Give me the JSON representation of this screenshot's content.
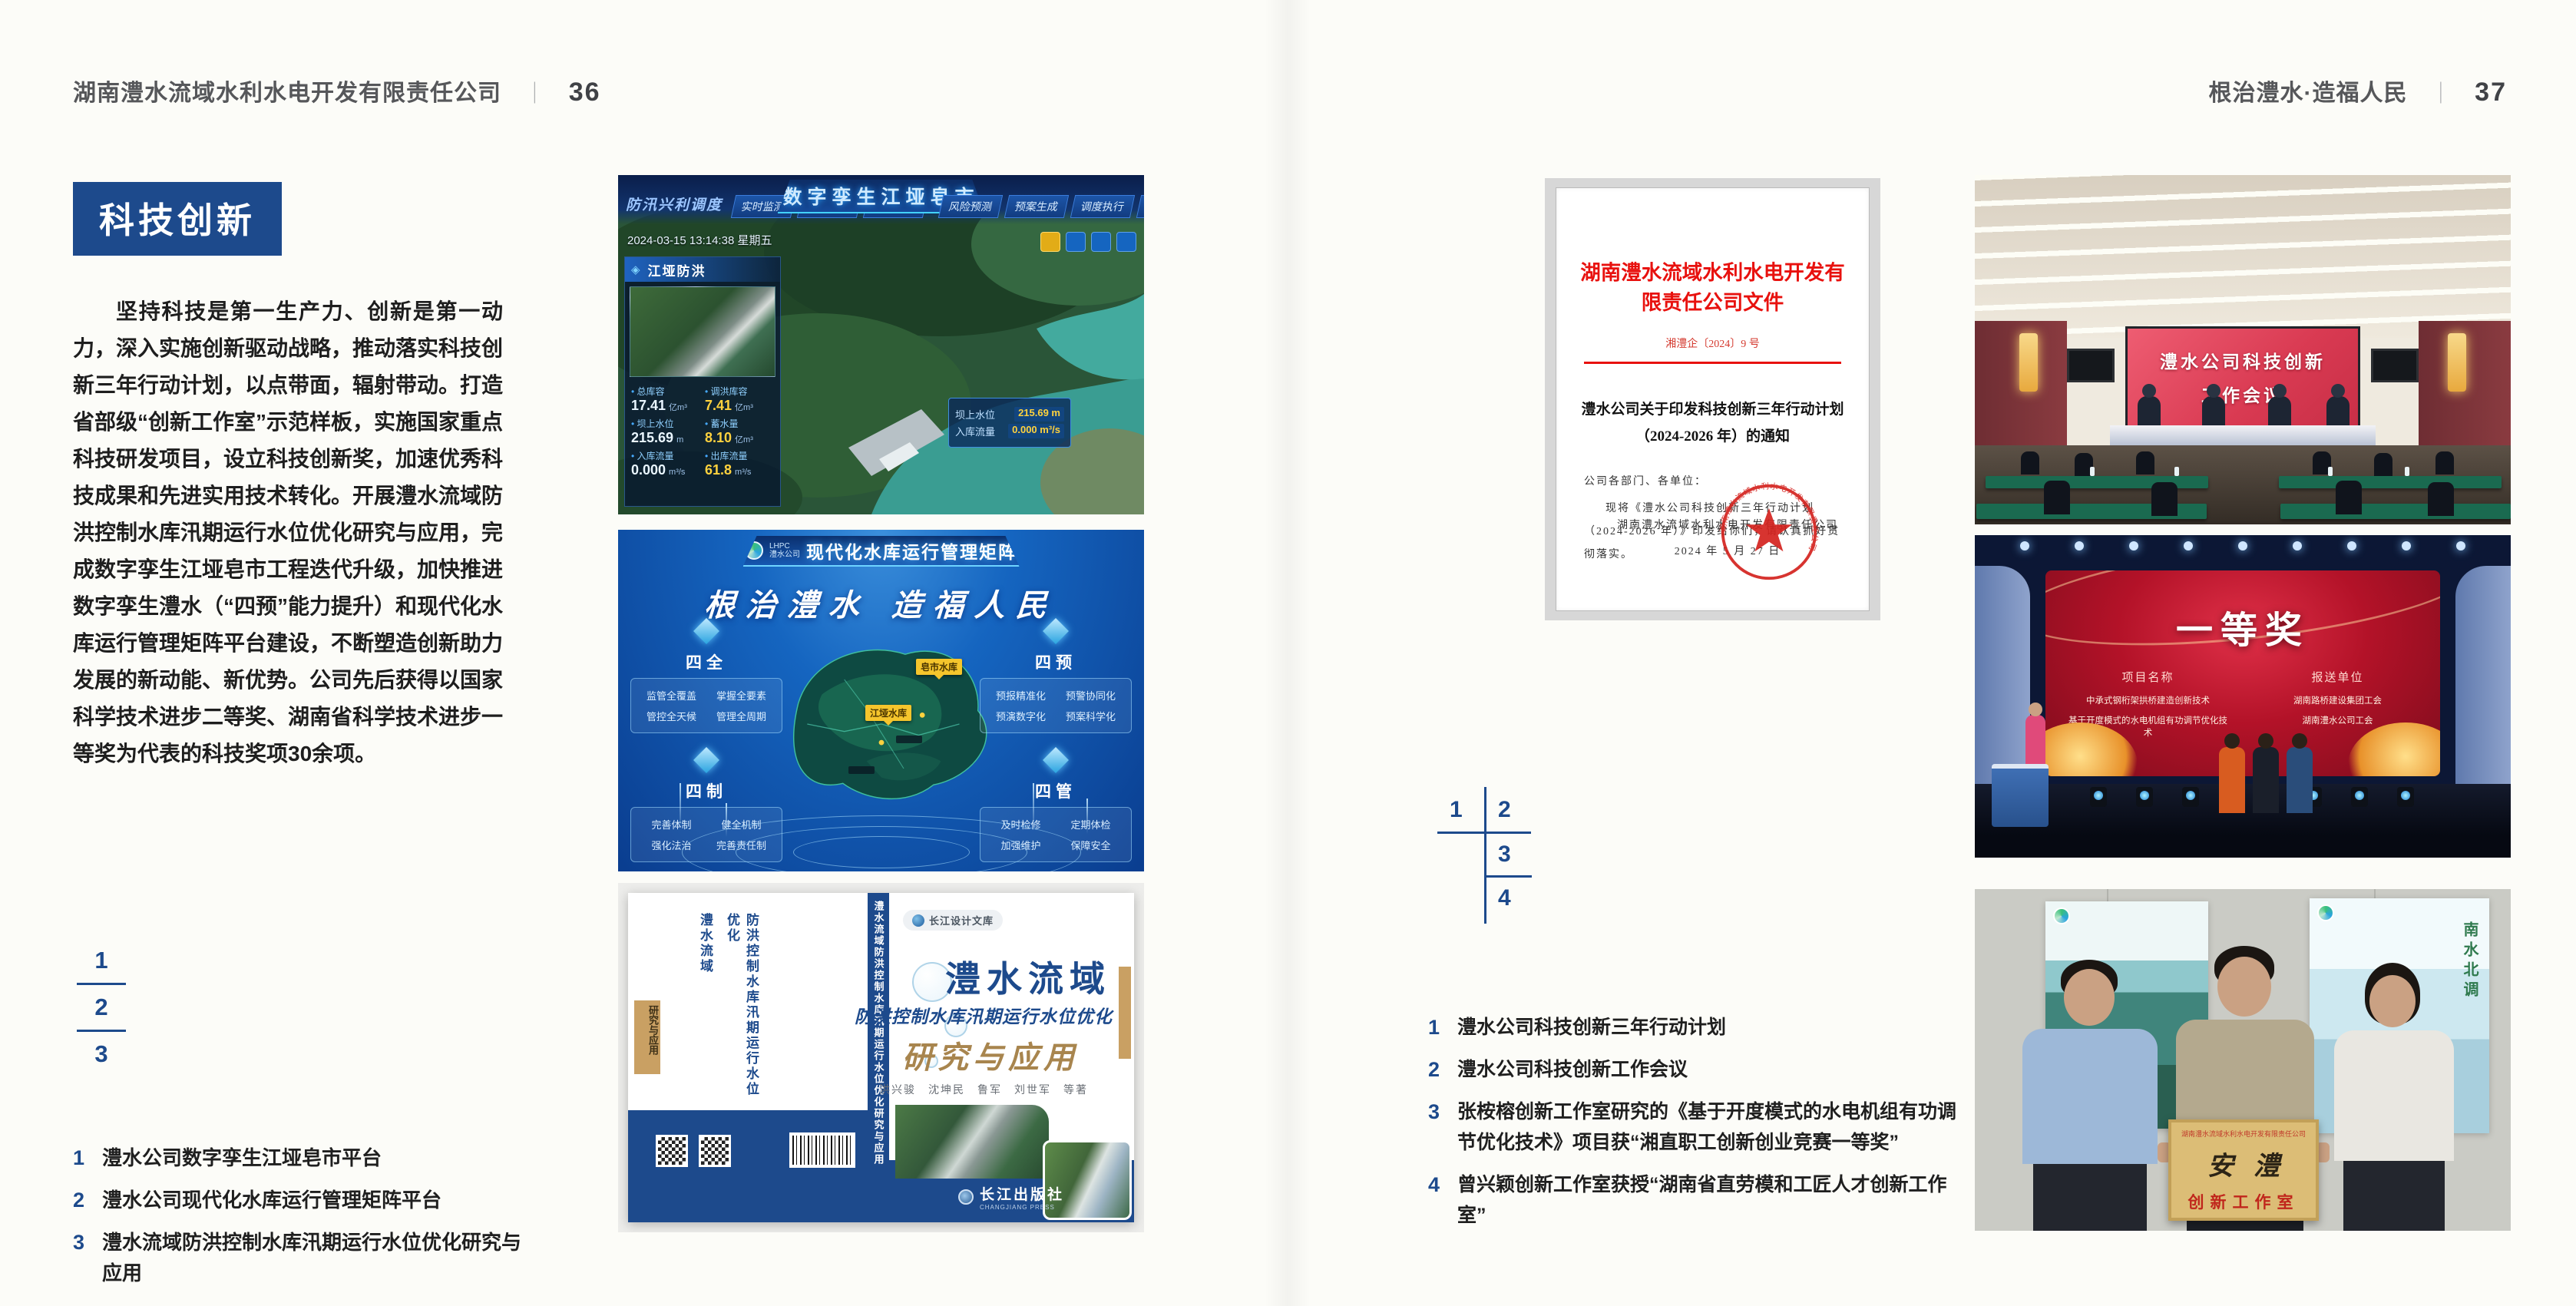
{
  "left_page": {
    "header_company": "湖南澧水流域水利水电开发有限责任公司",
    "header_sep": "｜",
    "header_page": "36",
    "section_title": "科技创新",
    "paragraph": "坚持科技是第一生产力、创新是第一动力，深入实施创新驱动战略，推动落实科技创新三年行动计划，以点带面，辐射带动。打造省部级“创新工作室”示范样板，实施国家重点科技研发项目，设立科技创新奖，加速优秀科技成果和先进实用技术转化。开展澧水流域防洪控制水库汛期运行水位优化研究与应用，完成数字孪生江垭皂市工程迭代升级，加快推进数字孪生澧水（“四预”能力提升）和现代化水库运行管理矩阵平台建设，不断塑造创新助力发展的新动能、新优势。公司先后获得以国家科学技术进步二等奖、湖南省科学技术进步一等奖为代表的科技奖项30余项。",
    "index": {
      "n1": "1",
      "n2": "2",
      "n3": "3"
    },
    "captions": [
      {
        "num": "1",
        "text": "澧水公司数字孪生江垭皂市平台"
      },
      {
        "num": "2",
        "text": "澧水公司现代化水库运行管理矩阵平台"
      },
      {
        "num": "3",
        "text": "澧水流域防洪控制水库汛期运行水位优化研究与应用"
      }
    ]
  },
  "right_page": {
    "header_slogan": "根治澧水·造福人民",
    "header_sep": "｜",
    "header_page": "37",
    "index": {
      "n1": "1",
      "n2": "2",
      "n3": "3",
      "n4": "4"
    },
    "captions": [
      {
        "num": "1",
        "text": "澧水公司科技创新三年行动计划"
      },
      {
        "num": "2",
        "text": "澧水公司科技创新工作会议"
      },
      {
        "num": "3",
        "text": "张桉榕创新工作室研究的《基于开度模式的水电机组有功调节优化技术》项目获“湘直职工创新创业竞赛一等奖”"
      },
      {
        "num": "4",
        "text": "曾兴颖创新工作室获授“湖南省直劳模和工匠人才创新工作室”"
      }
    ]
  },
  "fig_platform1": {
    "title": "数字孪生江垭皂市",
    "corner_label": "防汛兴利调度",
    "tabs_left": [
      "实时监测",
      "洪水预报",
      "防洪预警"
    ],
    "tabs_right": [
      "风险预测",
      "预案生成",
      "调度执行",
      "工程巡检"
    ],
    "timestamp": "2024-03-15 13:14:38 星期五",
    "panel_title": "江垭防洪",
    "stats": [
      {
        "label": "总库容",
        "value": "17.41",
        "unit": "亿m³"
      },
      {
        "label": "调洪库容",
        "value": "7.41",
        "unit": "亿m³"
      },
      {
        "label": "坝上水位",
        "value": "215.69",
        "unit": "m"
      },
      {
        "label": "蓄水量",
        "value": "8.10",
        "unit": "亿m³"
      },
      {
        "label": "入库流量",
        "value": "0.000",
        "unit": "m³/s"
      },
      {
        "label": "出库流量",
        "value": "61.8",
        "unit": "m³/s"
      }
    ],
    "float_tag": {
      "l1": "坝上水位",
      "v1": "215.69 m",
      "l2": "入库流量",
      "v2": "0.000 m³/s"
    }
  },
  "fig_platform2": {
    "logo_text": "LHPC\n澧水公司",
    "title": "现代化水库运行管理矩阵",
    "slogan": "根治澧水 造福人民",
    "panels": [
      {
        "name": "四全",
        "items": [
          "监管全覆盖",
          "掌握全要素",
          "管控全天候",
          "管理全周期"
        ]
      },
      {
        "name": "四预",
        "items": [
          "预报精准化",
          "预警协同化",
          "预演数字化",
          "预案科学化"
        ]
      },
      {
        "name": "四制",
        "items": [
          "完善体制",
          "健全机制",
          "强化法治",
          "完善责任制"
        ]
      },
      {
        "name": "四管",
        "items": [
          "及时检修",
          "定期体检",
          "加强维护",
          "保障安全"
        ]
      }
    ],
    "markers": [
      "皂市水库",
      "江垭水库"
    ]
  },
  "fig_book": {
    "series_badge": "长江设计文库",
    "title_main": "澧水流域",
    "title_sub": "防洪控制水库汛期运行水位优化",
    "title_tail": "研究与应用",
    "authors": "洪兴骏　沈坤民　鲁军　刘世军　等著",
    "spine_text": "澧水流域防洪控制水库汛期运行水位优化研究与应用",
    "back_title_1": "澧水流域",
    "back_title_2": "防洪控制水库汛期运行水位优化",
    "publisher": "长江出版社",
    "publisher_en": "CHANGJIANG PRESS"
  },
  "fig_document": {
    "header": "湖南澧水流域水利水电开发有限责任公司文件",
    "doc_no": "湘澧企〔2024〕9 号",
    "title_l1": "澧水公司关于印发科技创新三年行动计划",
    "title_l2": "（2024-2026 年）的通知",
    "salutation": "公司各部门、各单位：",
    "body": "现将《澧水公司科技创新三年行动计划（2024-2026 年）》印发给你们，请认真抓好贯彻落实。",
    "signer": "湖南澧水流域水利水电开发有限责任公司",
    "date": "2024 年 5 月 27 日",
    "seal_text": "湖南澧水流域水利水电开发有限责任公司"
  },
  "fig_meeting": {
    "screen_l1": "澧水公司科技创新",
    "screen_l2": "工作会议"
  },
  "fig_award": {
    "grade": "一等奖",
    "col1_header": "项目名称",
    "col1_rows": [
      "中承式钢桁架拱桥建造创新技术",
      "基于开度模式的水电机组有功调节优化技术"
    ],
    "col2_header": "报送单位",
    "col2_rows": [
      "湖南路桥建设集团工会",
      "湖南澧水公司工会"
    ]
  },
  "fig_plaque": {
    "plaque_top": "湖南澧水流域水利水电开发有限责任公司",
    "plaque_script": "安澧",
    "plaque_label": "创新工作室",
    "poster_right_text": "南水北调"
  }
}
